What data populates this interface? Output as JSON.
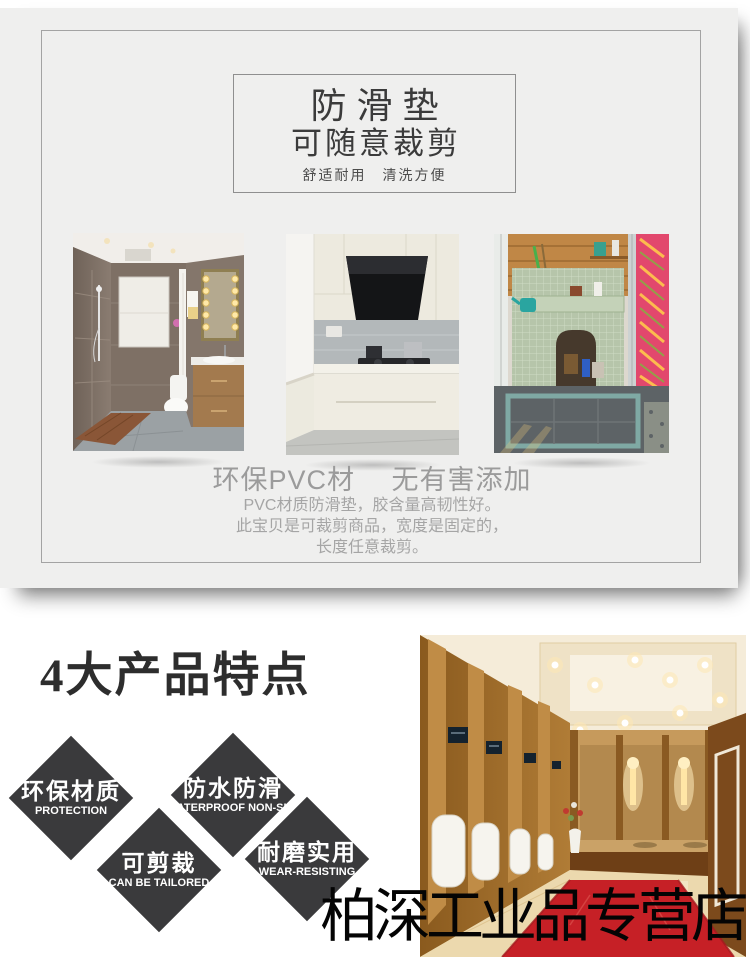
{
  "colors": {
    "panel_bg": "#efefee",
    "diamond": "#3a3a3c",
    "carpet_red": "#c62026",
    "muted_text": "#9b9b9b"
  },
  "hero": {
    "title": "防滑垫",
    "subtitle": "可随意裁剪",
    "tagline": "舒适耐用　清洗方便",
    "material_heading": "环保PVC材　 无有害添加",
    "description_lines": [
      "PVC材质防滑垫，胶含量高韧性好。",
      "此宝贝是可裁剪商品，宽度是固定的，",
      "长度任意裁剪。"
    ],
    "photos": [
      {
        "name": "bathroom-photo",
        "alt": "浴室场景"
      },
      {
        "name": "kitchen-photo",
        "alt": "厨房场景"
      },
      {
        "name": "balcony-photo",
        "alt": "阳台场景"
      }
    ]
  },
  "features": {
    "heading": "4大产品特点",
    "items": [
      {
        "zh": "环保材质",
        "en": "PROTECTION"
      },
      {
        "zh": "防水防滑",
        "en": "WATERPROOF NON-SLIP"
      },
      {
        "zh": "可剪裁",
        "en": "CAN BE TAILORED"
      },
      {
        "zh": "耐磨实用",
        "en": "WEAR-RESISTING"
      }
    ]
  },
  "scene": {
    "restroom_alt": "卫生间场景"
  },
  "store": {
    "name": "柏深工业品专营店"
  }
}
